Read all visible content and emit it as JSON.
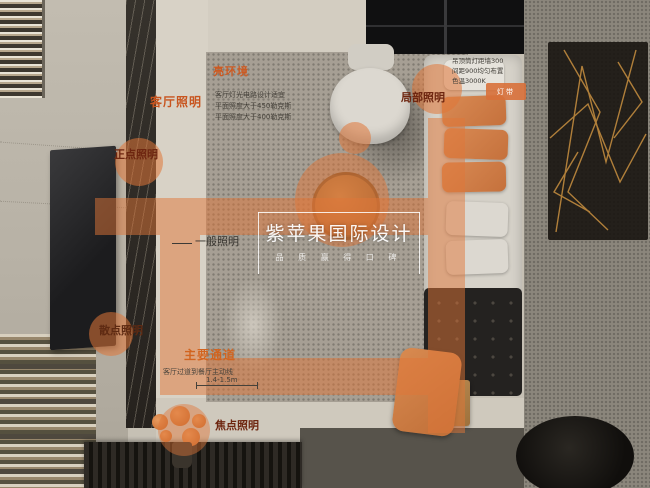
{
  "annotations": {
    "env": {
      "title": "亮环境",
      "line1": "客厅灯光电路设计适宜",
      "line2": "平面照度大于450勒克斯",
      "line3": "平面照度大于400勒克斯"
    },
    "living": "客厅照明",
    "spot": "正点照明",
    "general": "一般照明",
    "scatter": "散点照明",
    "passage": {
      "title": "主要通道",
      "desc": "客厅过道到餐厅主动线",
      "dim": "1.4-1.5m"
    },
    "focal": "焦点照明",
    "local": "局部照明",
    "ceiling_note": {
      "line1": "吊顶筒灯距墙300",
      "line2": "间距900均匀布置",
      "line3": "色温3000K"
    },
    "badge": "灯带"
  },
  "watermark": {
    "title": "紫苹果国际设计",
    "subtitle": "品 质 赢 得 口 碑"
  },
  "colors": {
    "annotation_orange": "#D8703A",
    "label_orange": "#C8551F",
    "label_dark_red": "#6E2610",
    "watermark_white": "#FFFFFF"
  }
}
